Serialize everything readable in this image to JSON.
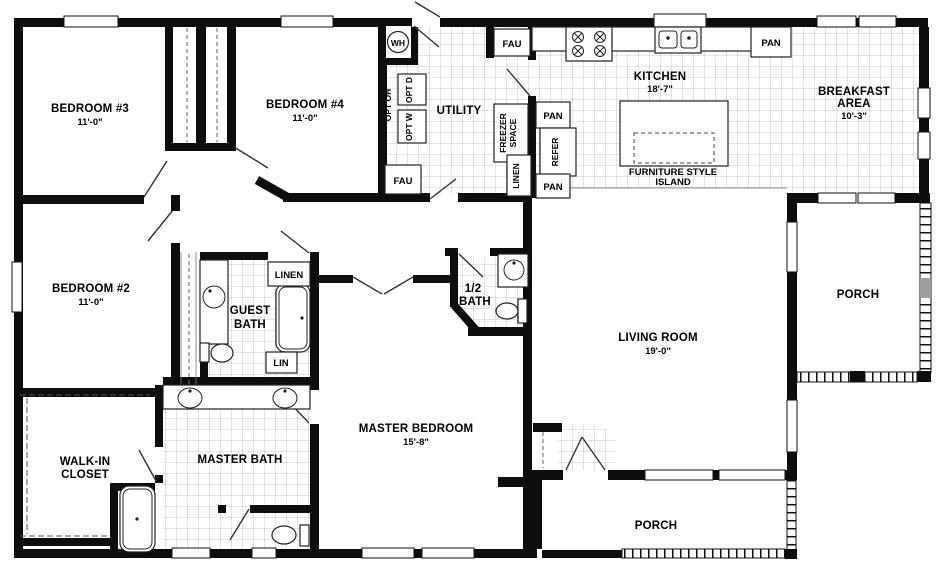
{
  "figure": {
    "type": "floor-plan"
  },
  "colors": {
    "wall": "#0d0d0d",
    "tile_line": "#9e9e9e",
    "rail_gray": "#9e9e9e",
    "bg": "#ffffff"
  },
  "rooms": {
    "bedroom3": {
      "name": "BEDROOM #3",
      "dim": "11'-0\""
    },
    "bedroom4": {
      "name": "BEDROOM #4",
      "dim": "11'-0\""
    },
    "bedroom2": {
      "name": "BEDROOM #2",
      "dim": "11'-0\""
    },
    "utility": {
      "name": "UTILITY"
    },
    "kitchen": {
      "name": "KITCHEN",
      "dim": "18'-7\""
    },
    "breakfast": {
      "line1": "BREAKFAST",
      "line2": "AREA",
      "dim": "10'-3\""
    },
    "island": {
      "line1": "FURNITURE STYLE",
      "line2": "ISLAND"
    },
    "guest_bath": {
      "line1": "GUEST",
      "line2": "BATH"
    },
    "half_bath": {
      "line1": "1/2",
      "line2": "BATH"
    },
    "living": {
      "name": "LIVING ROOM",
      "dim": "19'-0\""
    },
    "master_bedroom": {
      "name": "MASTER BEDROOM",
      "dim": "15'-8\""
    },
    "master_bath": {
      "name": "MASTER BATH"
    },
    "walkin": {
      "line1": "WALK-IN",
      "line2": "CLOSET"
    },
    "porch_right": {
      "name": "PORCH"
    },
    "porch_bottom": {
      "name": "PORCH"
    }
  },
  "closets": {
    "linen_hall": "LINEN",
    "lin": "LIN",
    "linen_utility": "LINEN"
  },
  "appliances": {
    "wh": "WH",
    "fau_top": "FAU",
    "fau_bottom": "FAU",
    "opt_oh": "OPT OH",
    "opt_d": "OPT D",
    "opt_w": "OPT W",
    "freezer_line1": "FREEZER",
    "freezer_line2": "SPACE",
    "pan_upper": "PAN",
    "pan_lower": "PAN",
    "pan_kitchen": "PAN",
    "refer": "REFER"
  }
}
